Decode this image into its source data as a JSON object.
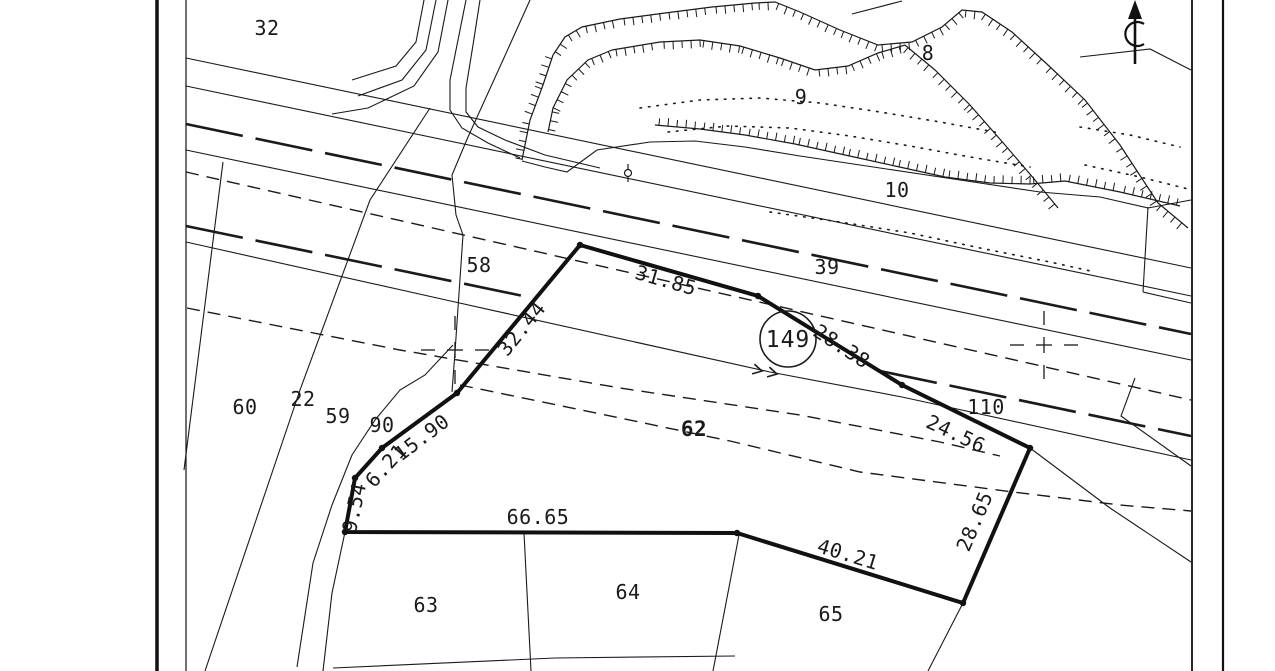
{
  "map": {
    "paper_color": "#ffffff",
    "ink_color": "#1a1a1a",
    "subject_parcel": {
      "number": "149",
      "boundary_points": "580,245 758,296 902,385 1030,448 963,603 737,533 345,532 355,478 382,448 457,393",
      "circle": {
        "cx": 788,
        "cy": 339,
        "r": 28
      },
      "edge_measurements": [
        {
          "text": "31.85",
          "x": 664,
          "y": 287,
          "rotate": 16
        },
        {
          "text": "28.38",
          "x": 838,
          "y": 352,
          "rotate": 33
        },
        {
          "text": "24.56",
          "x": 953,
          "y": 440,
          "rotate": 25
        },
        {
          "text": "28.65",
          "x": 981,
          "y": 524,
          "rotate": -67
        },
        {
          "text": "40.21",
          "x": 846,
          "y": 561,
          "rotate": 17
        },
        {
          "text": "66.65",
          "x": 538,
          "y": 524,
          "rotate": 0
        },
        {
          "text": "9.54",
          "x": 361,
          "y": 509,
          "rotate": -78
        },
        {
          "text": "6.21",
          "x": 391,
          "y": 470,
          "rotate": -48
        },
        {
          "text": "15.90",
          "x": 426,
          "y": 443,
          "rotate": -37
        },
        {
          "text": "32.44",
          "x": 527,
          "y": 333,
          "rotate": -51
        }
      ]
    },
    "parcel_labels": [
      {
        "text": "32",
        "x": 267,
        "y": 35
      },
      {
        "text": "8",
        "x": 928,
        "y": 60
      },
      {
        "text": "9",
        "x": 801,
        "y": 104
      },
      {
        "text": "10",
        "x": 897,
        "y": 197
      },
      {
        "text": "39",
        "x": 827,
        "y": 274
      },
      {
        "text": "58",
        "x": 479,
        "y": 272
      },
      {
        "text": "60",
        "x": 245,
        "y": 414
      },
      {
        "text": "22",
        "x": 303,
        "y": 406
      },
      {
        "text": "59",
        "x": 338,
        "y": 423
      },
      {
        "text": "90",
        "x": 382,
        "y": 432
      },
      {
        "text": "110",
        "x": 986,
        "y": 414
      },
      {
        "text": "62",
        "x": 694,
        "y": 436,
        "bold": true
      },
      {
        "text": "63",
        "x": 426,
        "y": 612
      },
      {
        "text": "64",
        "x": 628,
        "y": 599
      },
      {
        "text": "65",
        "x": 831,
        "y": 621
      }
    ],
    "symbols": {
      "north_arrow": "north-arrow",
      "grid_cross": "survey-grid-cross",
      "pole": "pole-marker",
      "flow_arrows": "line-direction-chevrons"
    }
  }
}
